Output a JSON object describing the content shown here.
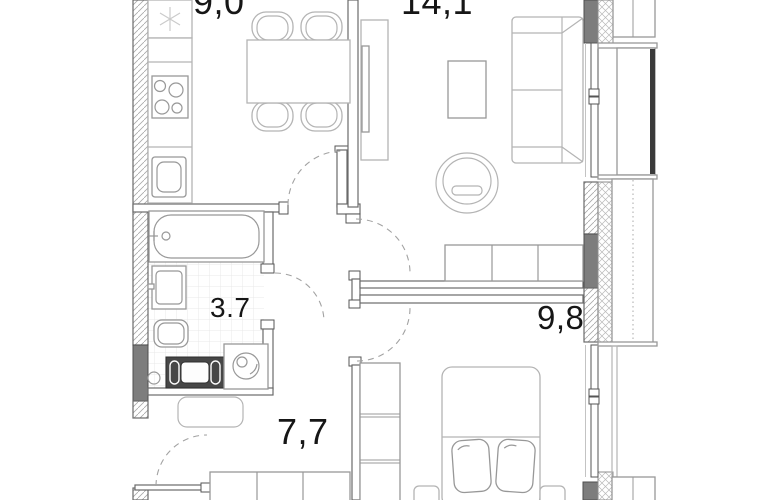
{
  "plan": {
    "title": "apartment-floor-plan",
    "rooms": [
      {
        "id": "kitchen",
        "area_label": "9,0"
      },
      {
        "id": "living-room",
        "area_label": "14,1"
      },
      {
        "id": "bathroom",
        "area_label": "3.7"
      },
      {
        "id": "bedroom",
        "area_label": "9,8"
      },
      {
        "id": "hallway",
        "area_label": "7,7"
      }
    ],
    "fixtures": [
      "fridge-icon",
      "stove-icon",
      "kitchen-sink-icon",
      "dining-table-icon",
      "chair-icon",
      "tv-icon",
      "coffee-table-icon",
      "sofa-icon",
      "armchair-icon",
      "closet-icon",
      "bathtub-icon",
      "washbasin-icon",
      "toilet-icon",
      "washing-machine-icon",
      "towel-dryer-icon",
      "bed-icon",
      "pillow-icon",
      "nightstand-icon",
      "wardrobe-icon",
      "bench-icon",
      "door-swing-icon",
      "window-icon",
      "balcony-icon",
      "snowflake-icon"
    ],
    "colors": {
      "wall_dark": "#7d7d7d",
      "line_light": "#b4b4b4",
      "line_wall": "#6a6a6a",
      "label": "#161616",
      "balcony_glass": "#3a3a3a"
    }
  }
}
